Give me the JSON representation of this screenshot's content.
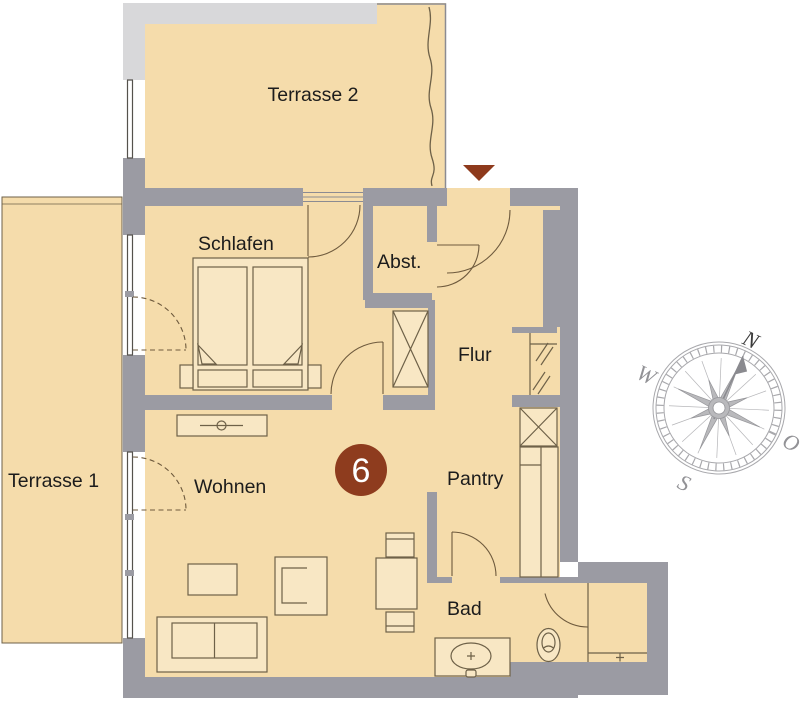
{
  "plan": {
    "unit_badge": "6",
    "rooms": {
      "terrasse2": "Terrasse 2",
      "terrasse1": "Terrasse 1",
      "schlafen": "Schlafen",
      "abstellraum": "Abst.",
      "flur": "Flur",
      "wohnen": "Wohnen",
      "pantry": "Pantry",
      "bad": "Bad"
    }
  },
  "compass": {
    "north": "N",
    "east": "O",
    "south": "S",
    "west": "W"
  },
  "colors": {
    "floor": "#f5dcab",
    "wall": "#9b9ba3",
    "wall_light": "#d8d8da",
    "accent": "#8e3c1e",
    "furniture": "#f8e7c4",
    "outline": "#6e6148"
  }
}
